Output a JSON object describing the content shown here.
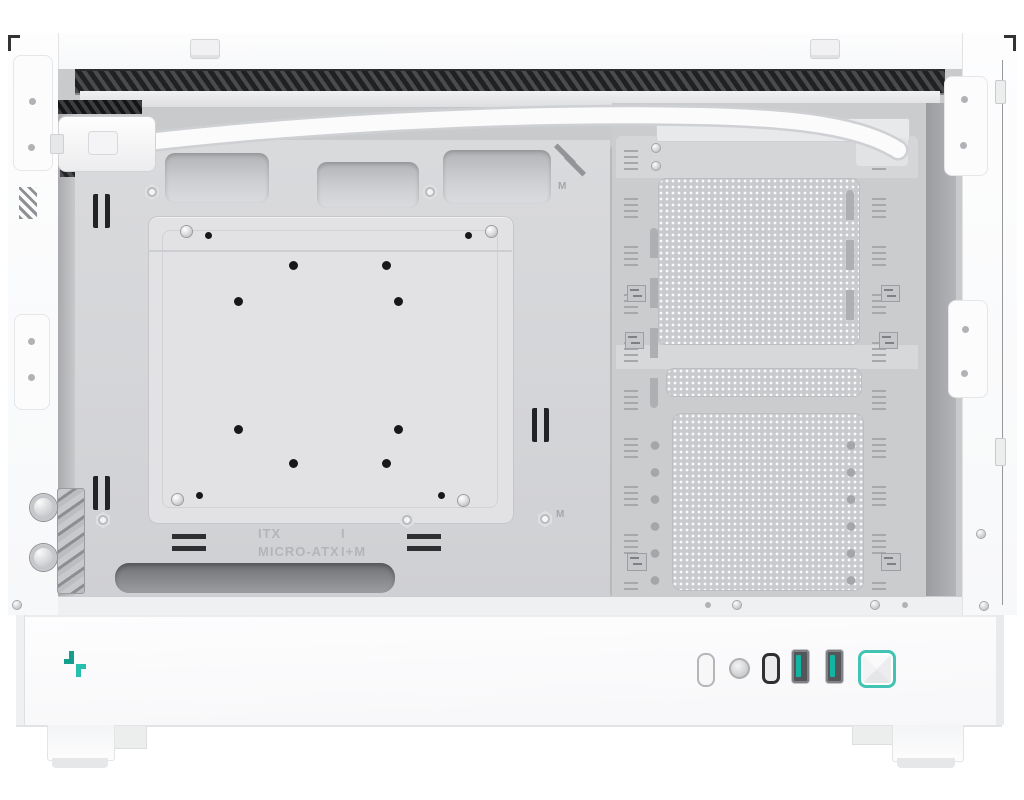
{
  "scene": {
    "type": "product-photo",
    "subject": "White mini-tower PC case shown from the open side with side panel removed, interior visible",
    "brand": "DeepCool",
    "colors": {
      "background": "#ffffff",
      "case_white": "#fbfbfc",
      "interior_gray": "#cfd0d3",
      "tray_gray": "#d9dadc",
      "mesh_gray": "#c9cacd",
      "vent_dark": "#2b2c2e",
      "accent_teal": "#2fbcab",
      "power_ring_teal": "#43c3b4",
      "usb_tab_teal": "#13b4a3"
    }
  },
  "tray": {
    "marking_itx": "ITX",
    "marking_itx_value": "I",
    "marking_matx": "MICRO-ATX",
    "marking_matx_value": "I+M",
    "marking_m_top": "M",
    "marking_m_bottom": "M"
  },
  "front_panel": {
    "logo_icon": "deepcool-logo",
    "io_icons": [
      "led-slot",
      "reset-button",
      "usb-c-port",
      "usb-a-port",
      "usb-a-port",
      "power-button"
    ]
  }
}
